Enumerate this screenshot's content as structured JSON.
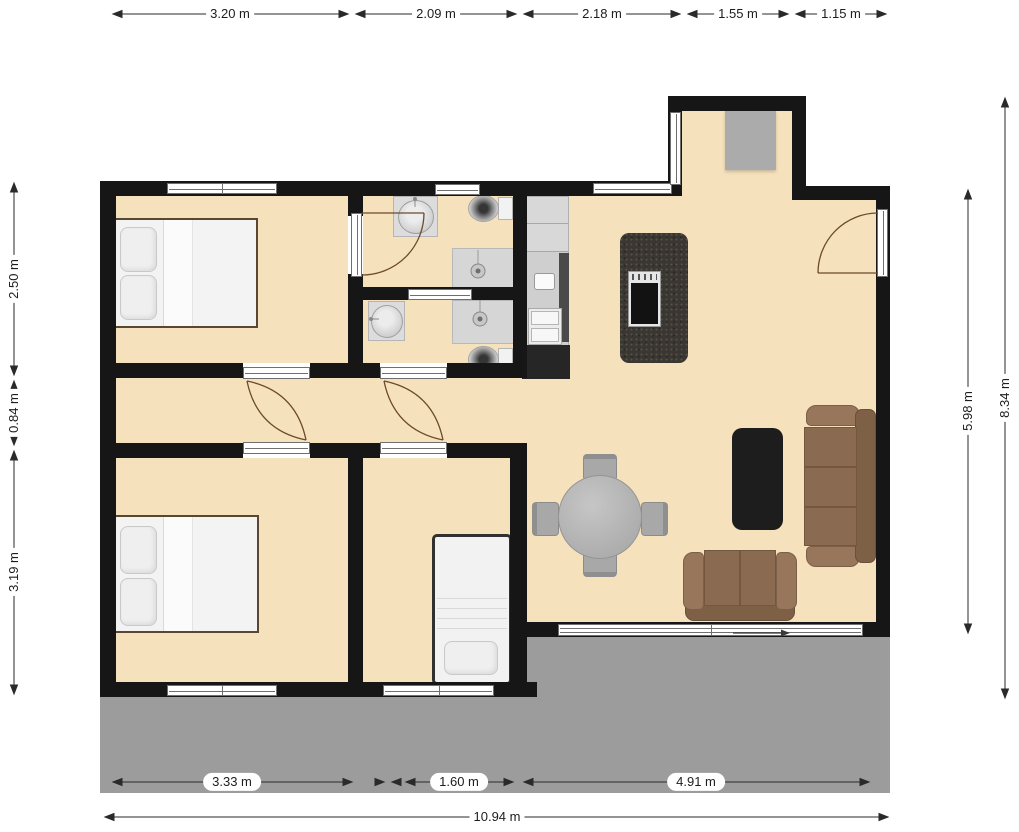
{
  "plan": {
    "dimensions_top": [
      "3.20 m",
      "2.09 m",
      "2.18 m",
      "1.55 m",
      "1.15 m"
    ],
    "dimensions_left": [
      "2.50 m",
      "0.84 m",
      "3.19 m"
    ],
    "dimensions_right": [
      "5.98 m",
      "8.34 m"
    ],
    "dimensions_bottom": [
      "3.33 m",
      "1.60 m",
      "4.91 m"
    ],
    "dimension_total_width": "10.94 m",
    "colors": {
      "wall": "#161616",
      "floor": "#f6e1bd",
      "terrace": "#9c9c9c",
      "sofa_brown": "#8b6a52",
      "island_charcoal": "#3a3632",
      "coffee_table_black": "#1d1d1d",
      "dining_table_gray": "#b5b5b5",
      "fixture_gray": "#d6d6d6",
      "door_arc_brown": "#6b4a2e"
    },
    "furniture_icons": [
      "double-bed-icon",
      "double-bed-icon",
      "single-bed-icon",
      "sofa-icon",
      "loveseat-icon",
      "coffee-table-icon",
      "round-dining-table-icon",
      "dining-chair-icon",
      "kitchen-island-icon",
      "cooktop-icon",
      "kitchen-counter-icon",
      "bathroom-sink-icon",
      "toilet-icon",
      "shower-icon",
      "doormat-icon",
      "door-swing-icon",
      "sliding-door-icon"
    ]
  }
}
